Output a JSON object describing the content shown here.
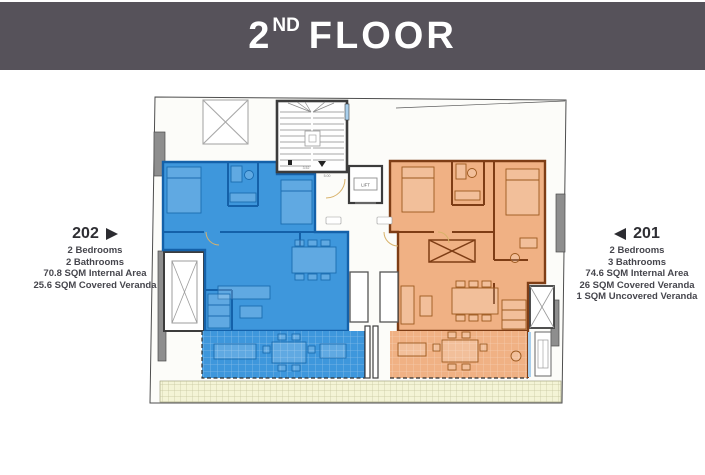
{
  "header": {
    "title": "2ND FLOOR",
    "number": "2",
    "ordinal": "ND",
    "word": "FLOOR"
  },
  "units": {
    "u202": {
      "number": "202",
      "specs": [
        "2 Bedrooms",
        "2 Bathrooms",
        "70.8 SQM Internal Area",
        "25.6 SQM Covered Veranda"
      ]
    },
    "u201": {
      "number": "201",
      "specs": [
        "2 Bedrooms",
        "3 Bathrooms",
        "74.6 SQM Internal Area",
        "26 SQM Covered Veranda",
        "1 SQM Uncovered Veranda"
      ]
    }
  },
  "plan": {
    "lift_label": "LIFT",
    "dim_a": "3.52",
    "dim_b": "5.00"
  },
  "colors": {
    "header_bg": "#56525A",
    "unit202_fill": "#3E97DC",
    "unit202_wall": "#1461A9",
    "unit201_fill": "#F0B184",
    "unit201_wall": "#7E3D15",
    "terrace_strip": "#F4F4D6",
    "paper": "#FCFCF9"
  }
}
